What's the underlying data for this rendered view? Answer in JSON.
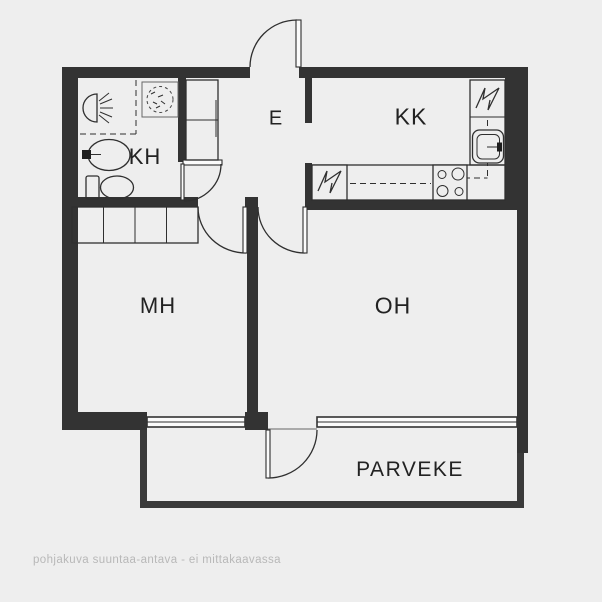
{
  "plan": {
    "rooms": {
      "kh": {
        "label": "KH"
      },
      "e": {
        "label": "E"
      },
      "kk": {
        "label": "KK"
      },
      "mh": {
        "label": "MH"
      },
      "oh": {
        "label": "OH"
      },
      "parveke": {
        "label": "PARVEKE"
      }
    },
    "footnote": "pohjakuva suuntaa-antava - ei mittakaavassa",
    "fixtures": [
      "shower-head-icon",
      "floor-drain-icon",
      "washbasin-icon",
      "toilet-icon",
      "hall-closet",
      "bedroom-wardrobes",
      "electrical-appliance-icon",
      "fridge-appliance-icon",
      "kitchen-sink-icon",
      "stove-burners-icon",
      "door-swing-arc",
      "window-band"
    ],
    "colors": {
      "background": "#eeeeee",
      "wall": "#333333",
      "wall_light": "#3a3a3a",
      "line": "#2f2f2f",
      "footnote": "#b8b8b8",
      "label": "#222222"
    }
  }
}
